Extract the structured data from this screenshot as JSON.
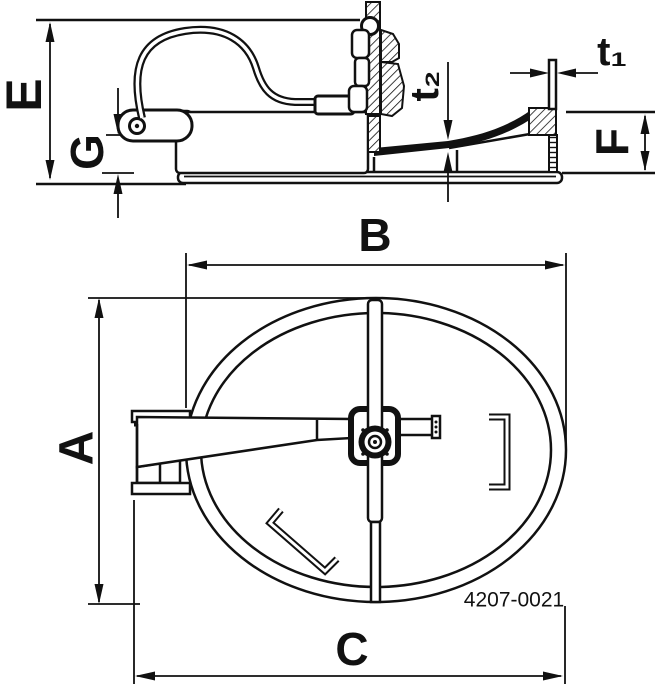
{
  "part_number": "4207-0021",
  "dimensions": {
    "E": "E",
    "G": "G",
    "A": "A",
    "B": "B",
    "C": "C",
    "F": "F",
    "t1": "t₁",
    "t2": "t₂"
  },
  "colors": {
    "line": "#111111",
    "background": "#ffffff"
  }
}
